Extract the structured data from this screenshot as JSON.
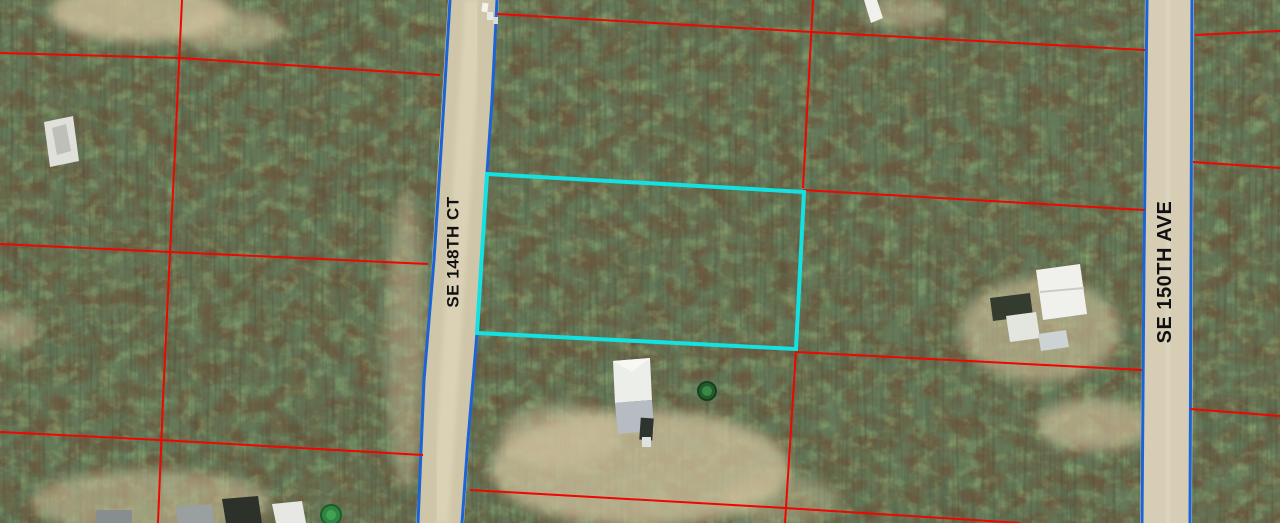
{
  "map": {
    "title": "Aerial parcel map with highlighted vacant lot",
    "colors": {
      "parcel_line": "#ee0600",
      "road_edge_line": "#1b64d8",
      "highlight_outline": "#12e2e2",
      "road_surface": "#cfc5a8",
      "label_text": "#101010"
    },
    "streets": [
      {
        "name": "SE 148TH CT"
      },
      {
        "name": "SE 150TH AVE"
      }
    ],
    "highlight_parcel": {
      "outline_points": "487,174 804,192 796,349 477,333"
    },
    "roads": {
      "se_148th_ct": {
        "surface_points": "448,0 499,0 464,523 416,523",
        "west_edge_points": "450,0 441,150 434,260 424,380 418,523",
        "east_edge_points": "497,0 492,100 487,173 477,333 468,440 462,523"
      },
      "se_150th_ave": {
        "surface_points": "1145,0 1194,0 1192,523 1140,523",
        "west_edge_points": "1147,0 1144,260 1142,523",
        "east_edge_points": "1192,0 1191,260 1190,523"
      }
    },
    "parcel_lines": {
      "west_block_h1": "M0,53 L180,58 L440,75",
      "west_block_h2": "M0,244 L170,252 L428,264",
      "west_block_h3": "M0,432 L160,440 L423,455",
      "west_block_v": "M182,0 L175,150 L170,252 L163,400 L158,523",
      "mid_block_h1": "M497,14 L812,32 L1145,50",
      "mid_block_h2": "M803,190 L1145,210",
      "mid_block_h3": "M796,352 L1142,370",
      "mid_block_h4": "M470,490 L785,508 L1020,523",
      "mid_block_v_upper": "M813,0 L803,188",
      "mid_block_v_lower": "M796,350 L785,523",
      "east_block_h1": "M1195,35 L1280,31",
      "east_block_h2": "M1193,162 L1280,168",
      "east_block_h3": "M1190,409 L1280,416"
    }
  }
}
